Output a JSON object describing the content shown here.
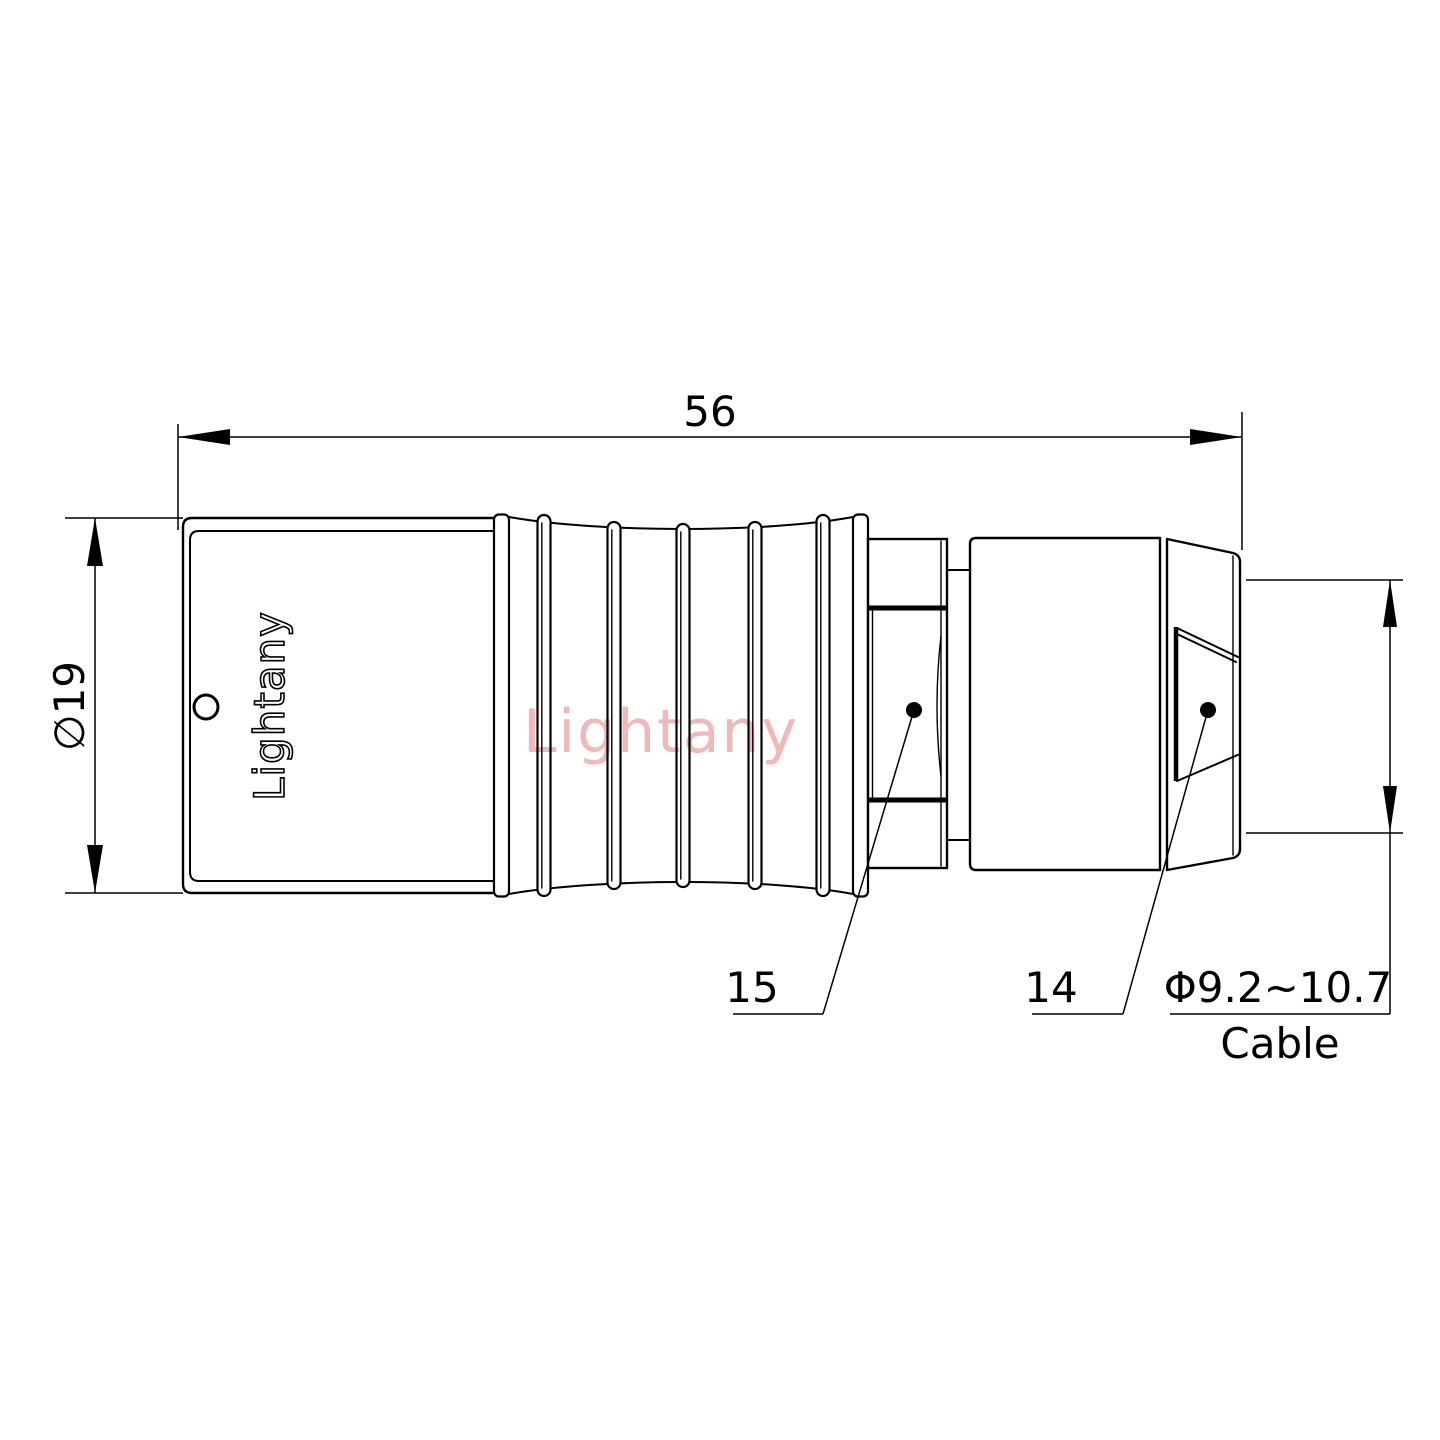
{
  "canvas": {
    "background": "#ffffff",
    "line_color": "#000000"
  },
  "watermark": {
    "text": "Lightany",
    "color": "#f2b8b8"
  },
  "connector": {
    "brand_text": "Lightany"
  },
  "dimensions": {
    "overall_length": {
      "text": "56"
    },
    "body_diameter": {
      "text": "∅19"
    },
    "cable": {
      "value_text": "Φ9.2~10.7",
      "label_text": "Cable"
    }
  },
  "part_labels": {
    "strain_relief": {
      "text": "15"
    },
    "cable_collet": {
      "text": "14"
    }
  }
}
